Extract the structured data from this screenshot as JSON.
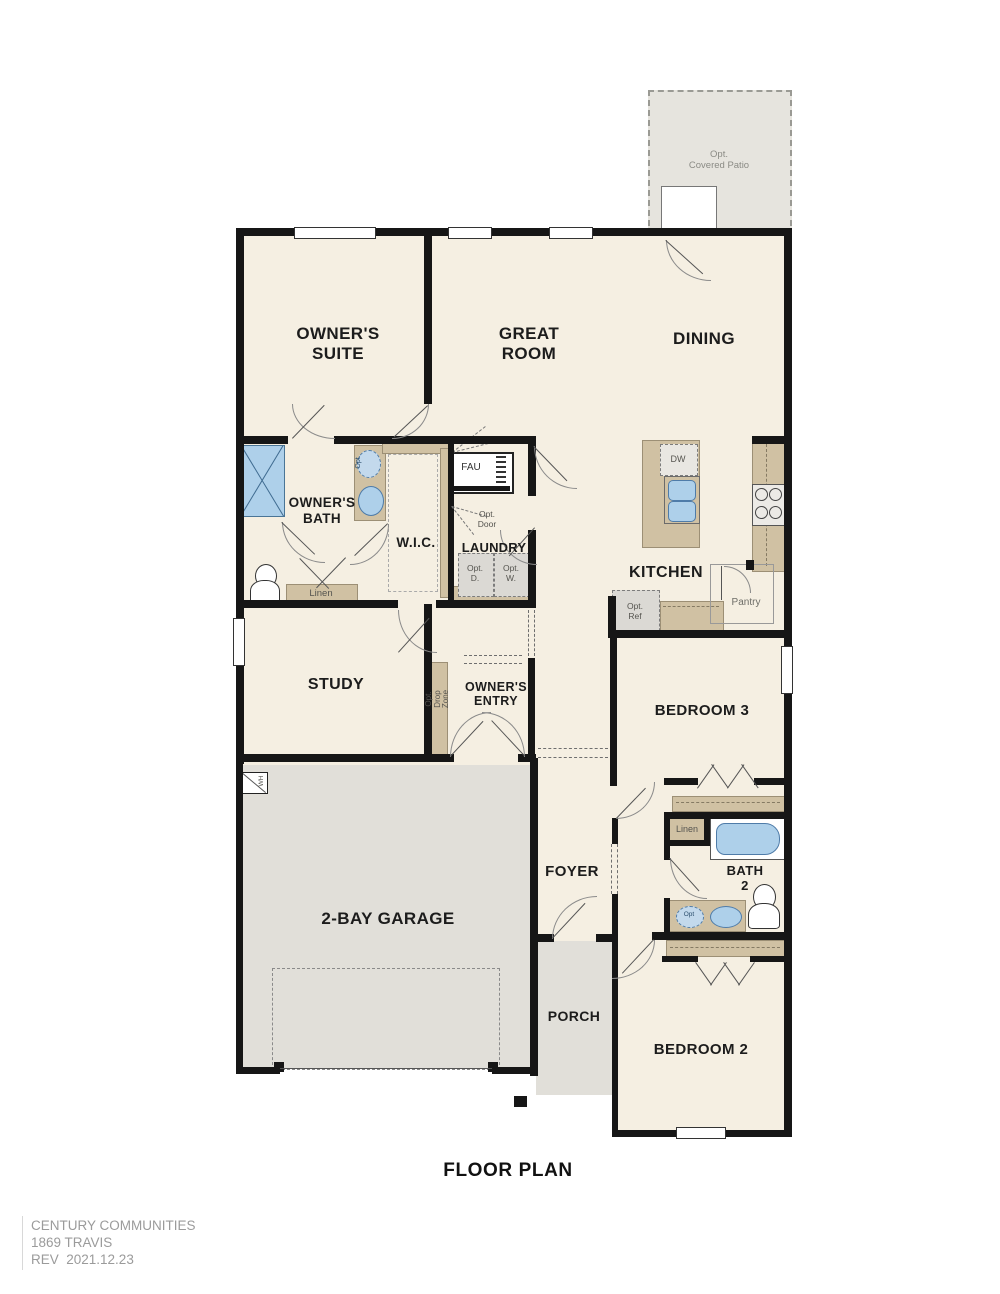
{
  "page": {
    "title": "FLOOR PLAN",
    "footer": {
      "line1": "CENTURY COMMUNITIES",
      "line2": "1869 TRAVIS",
      "line3": "REV  2021.12.23"
    }
  },
  "rooms": {
    "owners_suite": "OWNER'S\nSUITE",
    "great_room": "GREAT\nROOM",
    "dining": "DINING",
    "owners_bath": "OWNER'S\nBATH",
    "wic": "W.I.C.",
    "laundry": "LAUNDRY",
    "kitchen": "KITCHEN",
    "study": "STUDY",
    "owners_entry": "OWNER'S\nENTRY",
    "bedroom3": "BEDROOM 3",
    "bath2": "BATH\n2",
    "foyer": "FOYER",
    "porch": "PORCH",
    "garage": "2-BAY GARAGE",
    "bedroom2": "BEDROOM 2"
  },
  "annotations": {
    "opt_covered_patio": "Opt.\nCovered Patio",
    "fau": "FAU",
    "opt_door": "Opt.\nDoor",
    "opt_dryer": "Opt.\nD.",
    "opt_washer": "Opt.\nW.",
    "linen_bath1": "Linen",
    "linen_bath2": "Linen",
    "opt_sink_bath1": "Opt.",
    "opt_sink_bath2": "Opt",
    "dw": "DW",
    "opt_ref": "Opt.\nRef",
    "pantry": "Pantry",
    "opt_drop_zone": "Opt.\nDrop\nZone",
    "wh": "WH"
  },
  "colors": {
    "floor": "#f5efe2",
    "exterior": "#e1dfd9",
    "patio": "#e6e4de",
    "cabinet_tan": "#d0c1a3",
    "wall": "#161616",
    "fixture_blue": "#aed0ea",
    "fixture_blue_border": "#4f7ca9",
    "footer_gray": "#9b9b9b"
  }
}
